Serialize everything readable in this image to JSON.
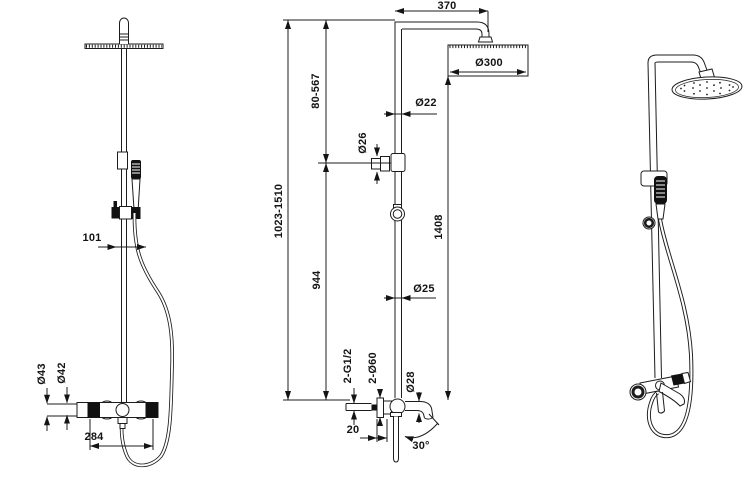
{
  "drawing": {
    "background": "#ffffff",
    "line_color": "#1c1c1c",
    "accent_fill": "#111111"
  },
  "dimensions": {
    "side_view": {
      "hand_shower_offset": "101",
      "valve_body_diameter": "Ø43",
      "valve_trim_diameter": "Ø42",
      "valve_width": "284"
    },
    "front_view": {
      "arm_length": "370",
      "head_diameter": "Ø300",
      "upper_adjust_range": "80-567",
      "upper_pipe_diameter": "Ø22",
      "holder_diameter": "Ø26",
      "total_height_range": "1023-1510",
      "head_to_valve_height": "1408",
      "lower_section_height": "944",
      "lower_pipe_diameter": "Ø25",
      "inlet_thread": "2-G1/2",
      "escutcheon_diameter": "2-Ø60",
      "spout_diameter": "Ø28",
      "wall_offset": "20",
      "spout_angle": "30°"
    }
  }
}
